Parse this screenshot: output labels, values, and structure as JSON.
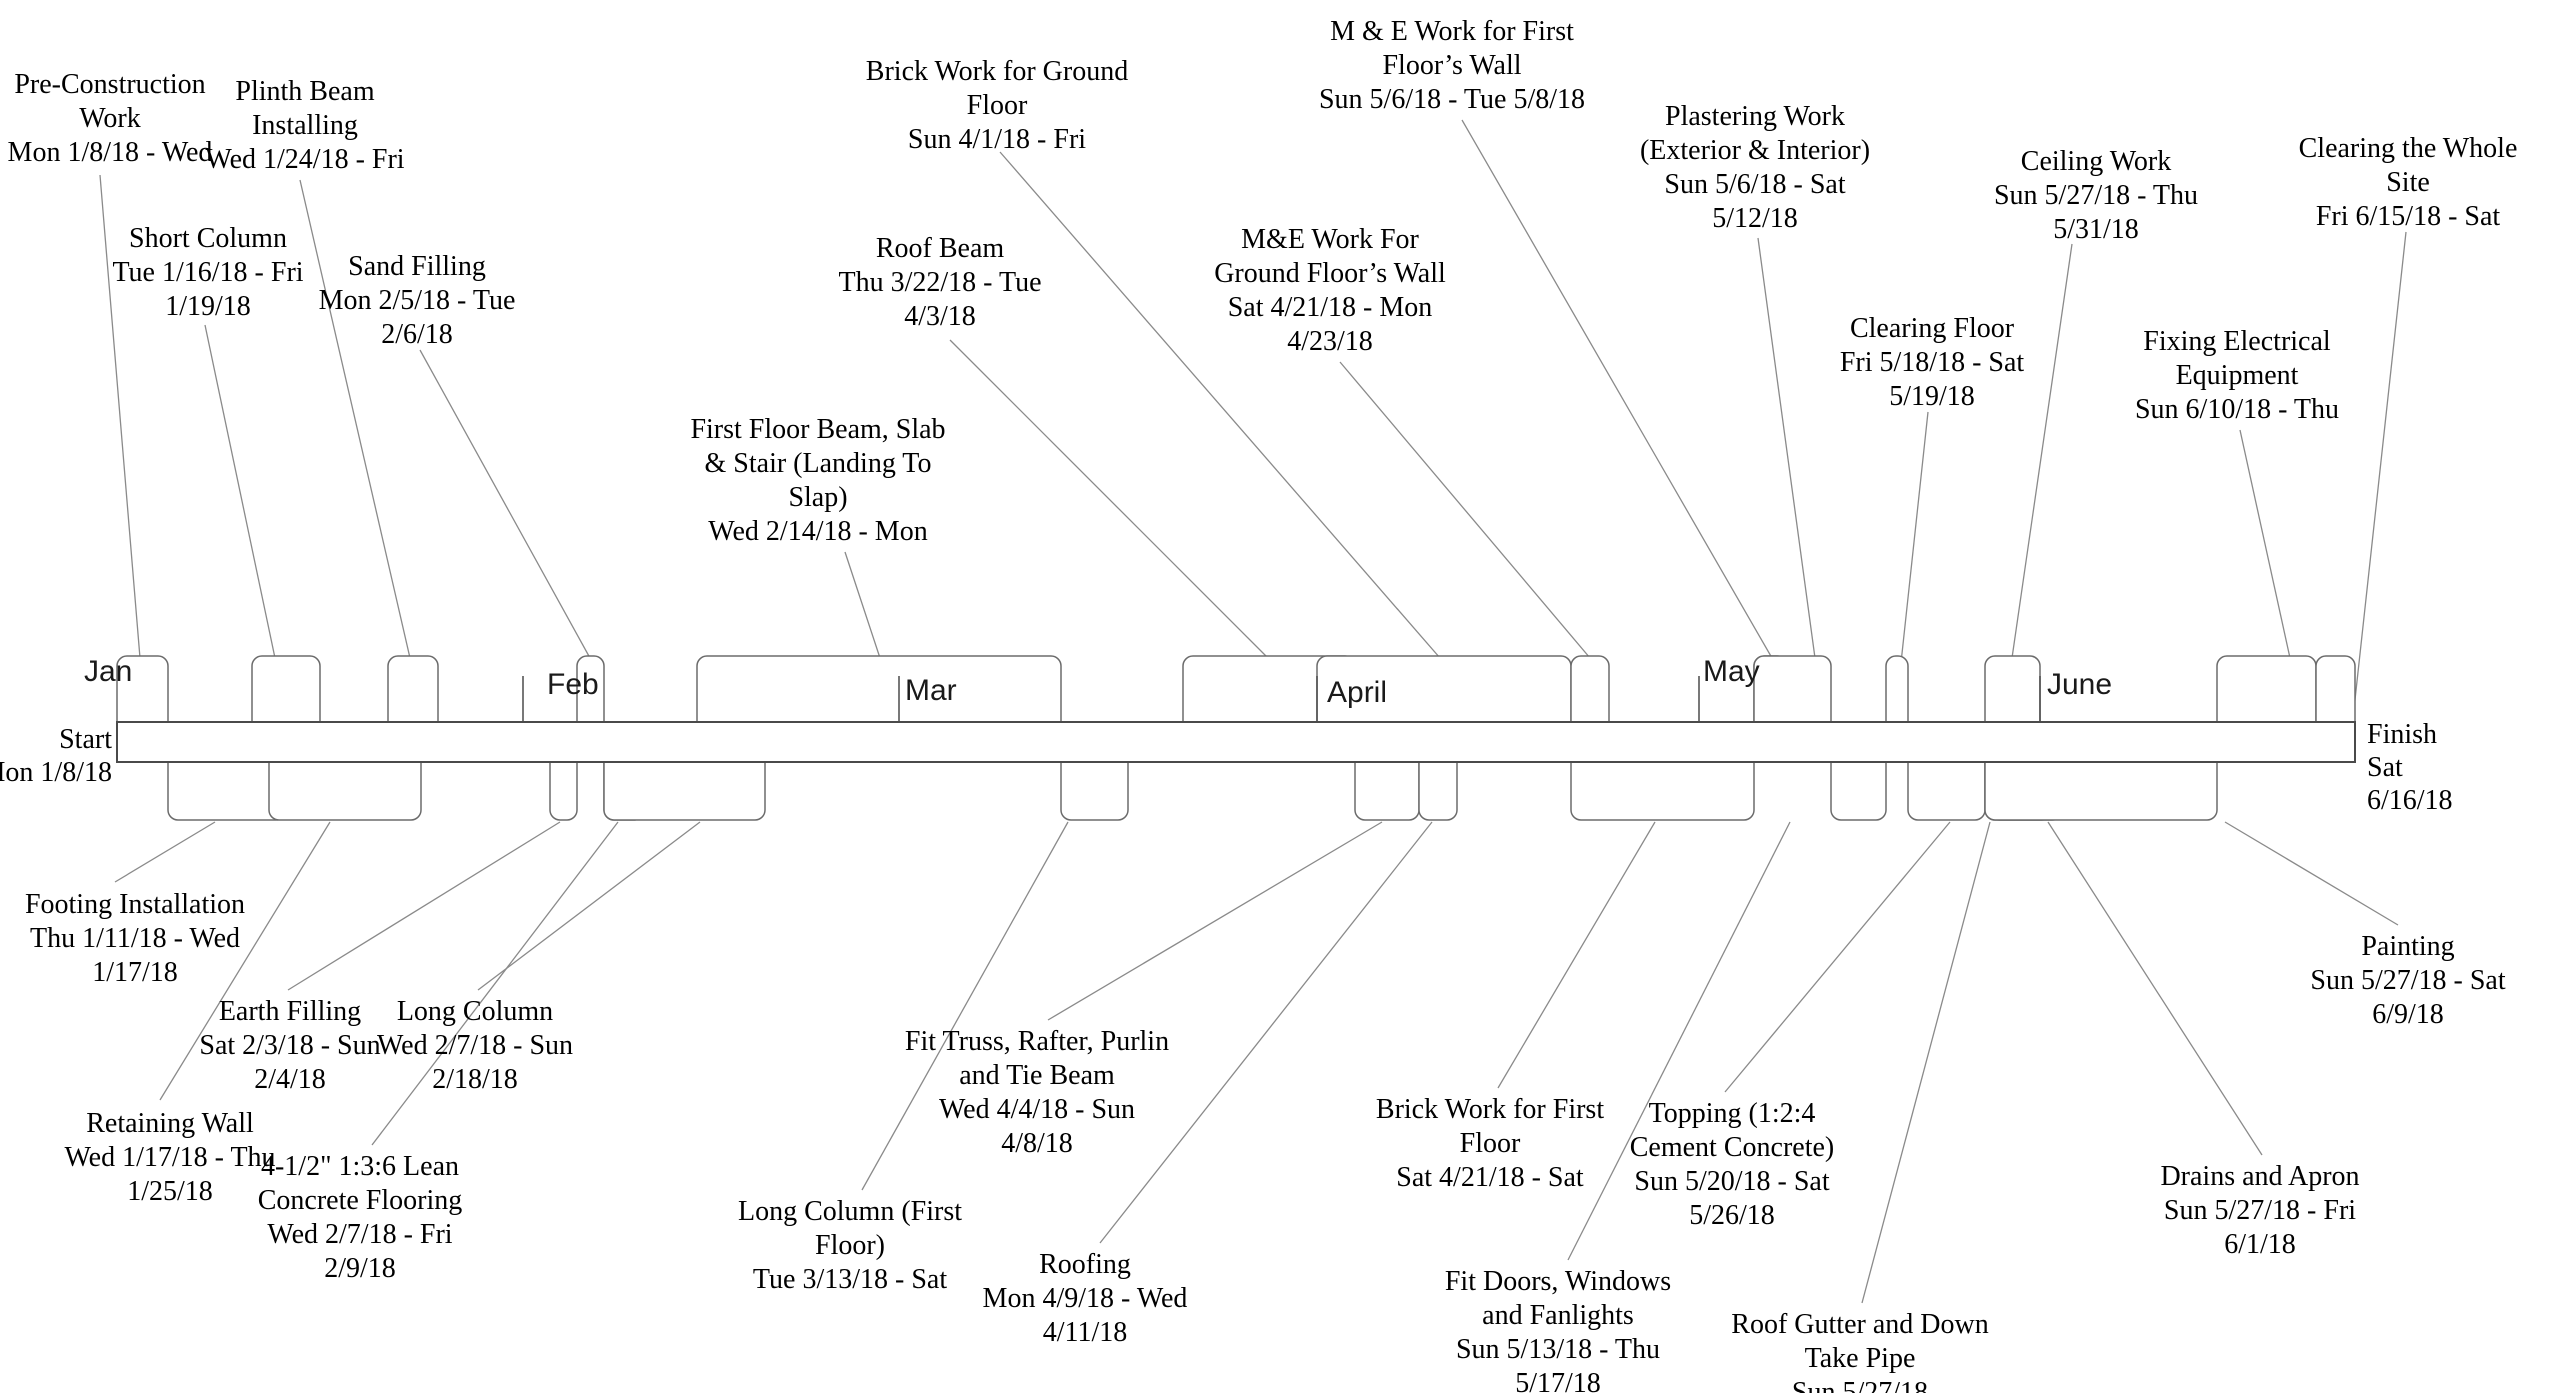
{
  "diagram_type": "project-timeline",
  "timeline": {
    "start": {
      "line1": "Start",
      "line2": "Mon 1/8/18"
    },
    "finish": {
      "line1": "Finish",
      "line2": "Sat",
      "line3": "6/16/18"
    },
    "bar": {
      "x0": 117,
      "x1": 2355,
      "y0": 722,
      "y1": 762
    },
    "months": [
      {
        "name": "Jan",
        "label_x": 84,
        "label_y": 655,
        "tick_x": null,
        "clip_w": null
      },
      {
        "name": "Feb",
        "label_x": 547,
        "label_y": 668,
        "tick_x": 523,
        "clip_w": null
      },
      {
        "name": "Mar",
        "label_x": 905,
        "label_y": 674,
        "tick_x": 899,
        "clip_w": null
      },
      {
        "name": "April",
        "label_x": 1327,
        "label_y": 676,
        "tick_x": 1317,
        "clip_w": 58
      },
      {
        "name": "May",
        "label_x": 1703,
        "label_y": 655,
        "tick_x": 1699,
        "clip_w": null
      },
      {
        "name": "June",
        "label_x": 2047,
        "label_y": 668,
        "tick_x": 2040,
        "clip_w": null
      }
    ]
  },
  "tasks": [
    {
      "name": "Pre-Construction Work",
      "dates": "Mon 1/8/18 - Wed",
      "side": "above",
      "lines": [
        "Pre-Construction",
        "Work",
        "Mon 1/8/18 - Wed"
      ],
      "box": [
        117,
        168
      ],
      "label_cx": 110,
      "label_top": 68,
      "leader": [
        100,
        175,
        140,
        658
      ]
    },
    {
      "name": "Short Column",
      "dates": "Tue 1/16/18 - Fri 1/19/18",
      "side": "above",
      "lines": [
        "Short Column",
        "Tue 1/16/18 - Fri",
        "1/19/18"
      ],
      "box": [
        252,
        320
      ],
      "label_cx": 208,
      "label_top": 222,
      "leader": [
        205,
        325,
        275,
        658
      ]
    },
    {
      "name": "Plinth Beam Installing",
      "dates": "Wed 1/24/18 - Fri",
      "side": "above",
      "lines": [
        "Plinth Beam",
        "Installing",
        "Wed 1/24/18 - Fri"
      ],
      "box": [
        388,
        438
      ],
      "label_cx": 305,
      "label_top": 75,
      "leader": [
        300,
        180,
        410,
        658
      ]
    },
    {
      "name": "Sand Filling",
      "dates": "Mon 2/5/18 - Tue 2/6/18",
      "side": "above",
      "lines": [
        "Sand Filling",
        "Mon 2/5/18 - Tue",
        "2/6/18"
      ],
      "box": [
        577,
        604
      ],
      "label_cx": 417,
      "label_top": 250,
      "leader": [
        420,
        350,
        590,
        658
      ]
    },
    {
      "name": "First Floor Beam, Slab & Stair (Landing To Slap)",
      "dates": "Wed 2/14/18 - Mon",
      "side": "above",
      "lines": [
        "First Floor Beam, Slab",
        "& Stair (Landing To",
        "Slap)",
        "Wed 2/14/18 - Mon"
      ],
      "box": [
        697,
        1061
      ],
      "label_cx": 818,
      "label_top": 413,
      "leader": [
        845,
        552,
        880,
        658
      ]
    },
    {
      "name": "Roof Beam",
      "dates": "Thu 3/22/18 - Tue 4/3/18",
      "side": "above",
      "lines": [
        "Roof Beam",
        "Thu 3/22/18 - Tue",
        "4/3/18"
      ],
      "box": [
        1183,
        1355
      ],
      "label_cx": 940,
      "label_top": 232,
      "leader": [
        950,
        340,
        1268,
        658
      ]
    },
    {
      "name": "Brick Work for Ground Floor",
      "dates": "Sun 4/1/18 - Fri",
      "side": "above",
      "lines": [
        "Brick Work for Ground",
        "Floor",
        "Sun 4/1/18 - Fri"
      ],
      "box": [
        1317,
        1571
      ],
      "label_cx": 997,
      "label_top": 55,
      "leader": [
        1000,
        152,
        1440,
        658
      ]
    },
    {
      "name": "M&E Work For Ground Floor’s Wall",
      "dates": "Sat 4/21/18 - Mon 4/23/18",
      "side": "above",
      "lines": [
        "M&E Work For",
        "Ground Floor’s Wall",
        "Sat 4/21/18 - Mon",
        "4/23/18"
      ],
      "box": [
        1571,
        1609
      ],
      "label_cx": 1330,
      "label_top": 223,
      "leader": [
        1340,
        362,
        1590,
        658
      ]
    },
    {
      "name": "M & E Work for First Floor’s Wall",
      "dates": "Sun 5/6/18 - Tue 5/8/18",
      "side": "above",
      "lines": [
        "M & E Work for First",
        "Floor’s Wall",
        "Sun 5/6/18 - Tue 5/8/18"
      ],
      "box": [
        1754,
        1787
      ],
      "label_cx": 1452,
      "label_top": 15,
      "leader": [
        1462,
        120,
        1772,
        658
      ]
    },
    {
      "name": "Plastering Work (Exterior & Interior)",
      "dates": "Sun 5/6/18 - Sat 5/12/18",
      "side": "above",
      "lines": [
        "Plastering Work",
        "(Exterior & Interior)",
        "Sun 5/6/18 - Sat",
        "5/12/18"
      ],
      "box": [
        1754,
        1831
      ],
      "label_cx": 1755,
      "label_top": 100,
      "leader": [
        1758,
        238,
        1815,
        658
      ]
    },
    {
      "name": "Clearing Floor",
      "dates": "Fri 5/18/18 - Sat 5/19/18",
      "side": "above",
      "lines": [
        "Clearing Floor",
        "Fri 5/18/18 - Sat",
        "5/19/18"
      ],
      "box": [
        1886,
        1908
      ],
      "label_cx": 1932,
      "label_top": 312,
      "leader": [
        1928,
        412,
        1897,
        700
      ]
    },
    {
      "name": "Ceiling Work",
      "dates": "Sun 5/27/18 - Thu 5/31/18",
      "side": "above",
      "lines": [
        "Ceiling Work",
        "Sun 5/27/18 - Thu",
        "5/31/18"
      ],
      "box": [
        1985,
        2040
      ],
      "label_cx": 2096,
      "label_top": 145,
      "leader": [
        2072,
        244,
        2012,
        658
      ]
    },
    {
      "name": "Fixing Electrical Equipment",
      "dates": "Sun 6/10/18 - Thu",
      "side": "above",
      "lines": [
        "Fixing Electrical",
        "Equipment",
        "Sun 6/10/18 - Thu"
      ],
      "box": [
        2217,
        2316
      ],
      "label_cx": 2237,
      "label_top": 325,
      "leader": [
        2240,
        430,
        2290,
        658
      ]
    },
    {
      "name": "Clearing the Whole Site",
      "dates": "Fri 6/15/18 - Sat",
      "side": "above",
      "lines": [
        "Clearing the Whole",
        "Site",
        "Fri 6/15/18 - Sat"
      ],
      "box": [
        2316,
        2355
      ],
      "label_cx": 2408,
      "label_top": 132,
      "leader": [
        2406,
        232,
        2353,
        718
      ]
    },
    {
      "name": "Footing Installation",
      "dates": "Thu 1/11/18 - Wed 1/17/18",
      "side": "below",
      "lines": [
        "Footing Installation",
        "Thu 1/11/18 - Wed",
        "1/17/18"
      ],
      "box": [
        168,
        286
      ],
      "label_cx": 135,
      "label_top": 888,
      "leader": [
        215,
        822,
        115,
        882
      ]
    },
    {
      "name": "Retaining Wall",
      "dates": "Wed 1/17/18 - Thu 1/25/18",
      "side": "below",
      "lines": [
        "Retaining Wall",
        "Wed 1/17/18 - Thu",
        "1/25/18"
      ],
      "box": [
        269,
        421
      ],
      "label_cx": 170,
      "label_top": 1107,
      "leader": [
        330,
        822,
        160,
        1100
      ]
    },
    {
      "name": "Earth Filling",
      "dates": "Sat 2/3/18 - Sun 2/4/18",
      "side": "below",
      "lines": [
        "Earth Filling",
        "Sat 2/3/18 - Sun",
        "2/4/18"
      ],
      "box": [
        550,
        577
      ],
      "label_cx": 290,
      "label_top": 995,
      "leader": [
        560,
        822,
        288,
        990
      ]
    },
    {
      "name": "4-1/2\" 1:3:6 Lean Concrete Flooring",
      "dates": "Wed 2/7/18 - Fri 2/9/18",
      "side": "below",
      "lines": [
        "4-1/2\" 1:3:6 Lean",
        "Concrete Flooring",
        "Wed 2/7/18 - Fri",
        "2/9/18"
      ],
      "box": [
        604,
        644
      ],
      "label_cx": 360,
      "label_top": 1150,
      "leader": [
        618,
        822,
        372,
        1145
      ]
    },
    {
      "name": "Long Column",
      "dates": "Wed 2/7/18 - Sun 2/18/18",
      "side": "below",
      "lines": [
        "Long Column",
        "Wed 2/7/18 - Sun",
        "2/18/18"
      ],
      "box": [
        604,
        765
      ],
      "label_cx": 475,
      "label_top": 995,
      "leader": [
        700,
        822,
        478,
        990
      ]
    },
    {
      "name": "Long Column (First Floor)",
      "dates": "Tue 3/13/18 - Sat",
      "side": "below",
      "lines": [
        "Long Column (First",
        "Floor)",
        "Tue 3/13/18 - Sat"
      ],
      "box": [
        1061,
        1128
      ],
      "label_cx": 850,
      "label_top": 1195,
      "leader": [
        1068,
        822,
        862,
        1190
      ]
    },
    {
      "name": "Fit Truss, Rafter, Purlin and Tie Beam",
      "dates": "Wed 4/4/18 - Sun 4/8/18",
      "side": "below",
      "lines": [
        "Fit Truss, Rafter, Purlin",
        "and Tie Beam",
        "Wed 4/4/18 - Sun",
        "4/8/18"
      ],
      "box": [
        1355,
        1419
      ],
      "label_cx": 1037,
      "label_top": 1025,
      "leader": [
        1382,
        822,
        1048,
        1020
      ]
    },
    {
      "name": "Roofing",
      "dates": "Mon 4/9/18 - Wed 4/11/18",
      "side": "below",
      "lines": [
        "Roofing",
        "Mon 4/9/18 - Wed",
        "4/11/18"
      ],
      "box": [
        1419,
        1457
      ],
      "label_cx": 1085,
      "label_top": 1248,
      "leader": [
        1432,
        822,
        1100,
        1243
      ]
    },
    {
      "name": "Brick Work for First Floor",
      "dates": "Sat 4/21/18 - Sat",
      "side": "below",
      "lines": [
        "Brick Work for First",
        "Floor",
        "Sat 4/21/18 - Sat"
      ],
      "box": [
        1571,
        1754
      ],
      "label_cx": 1490,
      "label_top": 1093,
      "leader": [
        1655,
        822,
        1498,
        1088
      ]
    },
    {
      "name": "Fit Doors, Windows and Fanlights",
      "dates": "Sun 5/13/18 - Thu 5/17/18",
      "side": "below",
      "lines": [
        "Fit Doors, Windows",
        "and Fanlights",
        "Sun 5/13/18 - Thu",
        "5/17/18"
      ],
      "box": [
        1831,
        1886
      ],
      "label_cx": 1558,
      "label_top": 1265,
      "leader": [
        1790,
        822,
        1568,
        1260
      ]
    },
    {
      "name": "Topping (1:2:4 Cement Concrete)",
      "dates": "Sun 5/20/18 - Sat 5/26/18",
      "side": "below",
      "lines": [
        "Topping (1:2:4",
        "Cement Concrete)",
        "Sun 5/20/18 - Sat",
        "5/26/18"
      ],
      "box": [
        1908,
        1985
      ],
      "label_cx": 1732,
      "label_top": 1097,
      "leader": [
        1950,
        822,
        1725,
        1092
      ]
    },
    {
      "name": "Roof Gutter and Down Take Pipe",
      "dates": "Sun 5/27/18",
      "side": "below",
      "lines": [
        "Roof Gutter and Down",
        "Take Pipe",
        "Sun 5/27/18"
      ],
      "box": [
        1985,
        2062
      ],
      "label_cx": 1860,
      "label_top": 1308,
      "leader": [
        1990,
        822,
        1862,
        1303
      ]
    },
    {
      "name": "Drains and Apron",
      "dates": "Sun 5/27/18 - Fri 6/1/18",
      "side": "below",
      "lines": [
        "Drains and Apron",
        "Sun 5/27/18 - Fri",
        "6/1/18"
      ],
      "box": [
        1990,
        2051
      ],
      "label_cx": 2260,
      "label_top": 1160,
      "leader": [
        2048,
        822,
        2262,
        1155
      ]
    },
    {
      "name": "Painting",
      "dates": "Sun 5/27/18 - Sat 6/9/18",
      "side": "below",
      "lines": [
        "Painting",
        "Sun 5/27/18 - Sat",
        "6/9/18"
      ],
      "box": [
        1985,
        2217
      ],
      "label_cx": 2408,
      "label_top": 930,
      "leader": [
        2225,
        822,
        2398,
        925
      ]
    }
  ],
  "colors": {
    "background": "#ffffff",
    "bar_border": "#4a4a4a",
    "box_border": "#6b6b6b",
    "leader_line": "#8a8a8a",
    "tick": "#4a4a4a",
    "text": "#000000"
  }
}
